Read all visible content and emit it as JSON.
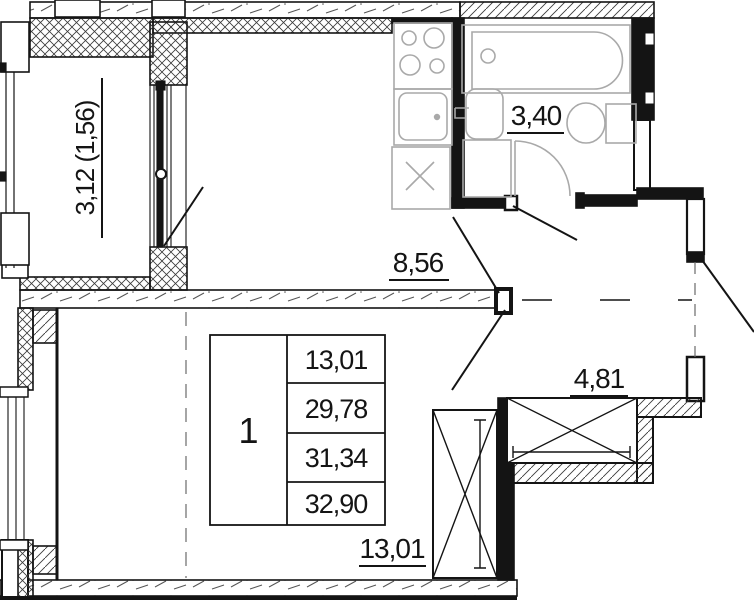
{
  "plan": {
    "title": "apartment-floor-plan",
    "unit_number": "1",
    "labels": {
      "balcony_area": "3,12 (1,56)",
      "bathroom_area": "3,40",
      "kitchen_area": "8,56",
      "hallway_area": "4,81",
      "room_area": "13,01"
    },
    "area_table": {
      "unit": "1",
      "rows": [
        "13,01",
        "29,78",
        "31,34",
        "32,90"
      ]
    },
    "colors": {
      "wall": "#141414",
      "fixture": "#a9a9a9",
      "hatch": "#444444",
      "background": "#ffffff"
    }
  }
}
